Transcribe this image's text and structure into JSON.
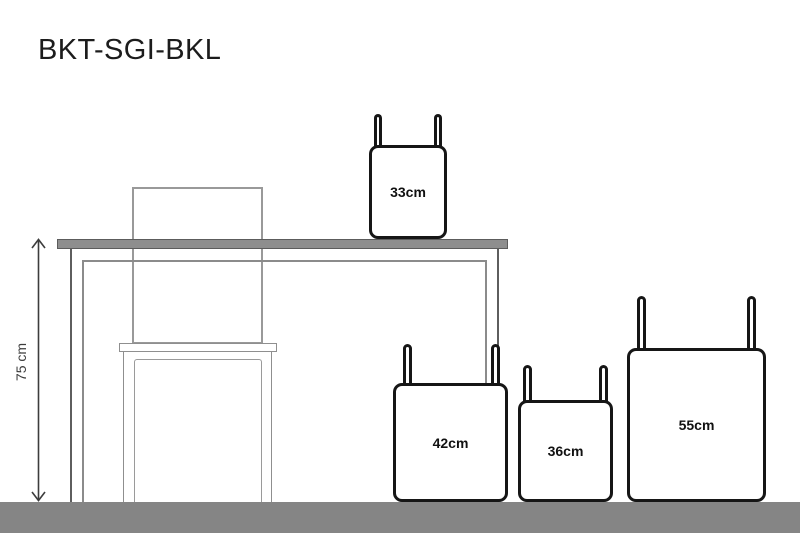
{
  "title": "BKT-SGI-BKL",
  "dimension": {
    "label": "75 cm",
    "measures": "table-height",
    "arrow_style": "double-headed-vertical"
  },
  "bags": [
    {
      "name": "bag-on-table",
      "label": "33cm"
    },
    {
      "name": "bag-floor-left",
      "label": "42cm"
    },
    {
      "name": "bag-floor-middle",
      "label": "36cm"
    },
    {
      "name": "bag-floor-right",
      "label": "55cm"
    }
  ],
  "scene": {
    "furniture": [
      "table",
      "chair"
    ],
    "floor": true
  },
  "colors": {
    "background": "#ffffff",
    "floor": "#858585",
    "tabletop_fill": "#8e8e8e",
    "tabletop_border": "#5c5c5c",
    "furniture_line": "#8f8f8f",
    "bag_outline": "#161616",
    "title_text": "#1c1c1c",
    "dimension_text": "#3d3d3d"
  }
}
